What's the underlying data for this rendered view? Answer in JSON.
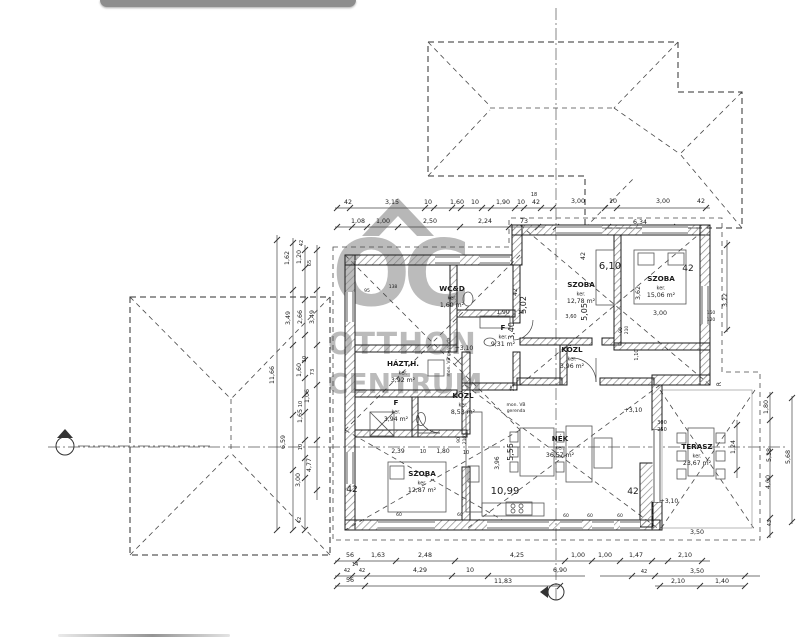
{
  "chrome": {
    "top_bar_color": "#8d8d8d"
  },
  "watermark": {
    "logo_text": "OC",
    "line1": "OTTHON",
    "line2": "CENTRUM",
    "color": "#7c7c7c"
  },
  "plan": {
    "rooms": [
      {
        "name": "WC&D",
        "mid": "ker.",
        "area": "1,60 m²",
        "x": 452,
        "y": 291
      },
      {
        "name": "F",
        "mid": "ker.",
        "area": "9,31 m²",
        "x": 503,
        "y": 330
      },
      {
        "name": "HÁZT.H.",
        "mid": "ker.",
        "area": "3,92 m²",
        "x": 403,
        "y": 366
      },
      {
        "name": "KÖZL",
        "mid": "ker.",
        "area": "8,53 m²",
        "x": 463,
        "y": 398
      },
      {
        "name": "F",
        "mid": "ker.",
        "area": "3,94 m²",
        "x": 396,
        "y": 405
      },
      {
        "name": "KÖZL",
        "mid": "ker.",
        "area": "3,96 m²",
        "x": 572,
        "y": 352
      },
      {
        "name": "SZOBA",
        "mid": "ker.",
        "area": "12,78 m²",
        "x": 581,
        "y": 287
      },
      {
        "name": "SZOBA",
        "mid": "ker.",
        "area": "15,06 m²",
        "x": 661,
        "y": 281
      },
      {
        "name": "SZOBA",
        "mid": "ker.",
        "area": "12,87 m²",
        "x": 422,
        "y": 476
      },
      {
        "name": "NÉK",
        "mid": "ker.",
        "area": "36,57 m²",
        "x": 560,
        "y": 441
      },
      {
        "name": "TERASZ",
        "mid": "ker.",
        "area": "23,67 m²",
        "x": 697,
        "y": 449
      }
    ],
    "dims": [
      {
        "t": "42",
        "x": 348,
        "y": 204
      },
      {
        "t": "3,15",
        "x": 392,
        "y": 204
      },
      {
        "t": "10",
        "x": 428,
        "y": 204
      },
      {
        "t": "1,60",
        "x": 457,
        "y": 204
      },
      {
        "t": "10",
        "x": 475,
        "y": 204
      },
      {
        "t": "1,90",
        "x": 503,
        "y": 204
      },
      {
        "t": "10",
        "x": 521,
        "y": 204
      },
      {
        "t": "42",
        "x": 536,
        "y": 204
      },
      {
        "t": "18",
        "x": 534,
        "y": 196,
        "s": 5
      },
      {
        "t": "3,00",
        "x": 578,
        "y": 203
      },
      {
        "t": "10",
        "x": 613,
        "y": 203
      },
      {
        "t": "3,00",
        "x": 663,
        "y": 203
      },
      {
        "t": "42",
        "x": 701,
        "y": 203
      },
      {
        "t": "1,08",
        "x": 358,
        "y": 223
      },
      {
        "t": "1,00",
        "x": 383,
        "y": 223
      },
      {
        "t": "2,50",
        "x": 430,
        "y": 223
      },
      {
        "t": "2,24",
        "x": 485,
        "y": 223
      },
      {
        "t": "73",
        "x": 524,
        "y": 223
      },
      {
        "t": "6,34",
        "x": 640,
        "y": 224
      },
      {
        "t": "56",
        "x": 350,
        "y": 557
      },
      {
        "t": "1,63",
        "x": 378,
        "y": 557
      },
      {
        "t": "2,48",
        "x": 425,
        "y": 557
      },
      {
        "t": "4,25",
        "x": 517,
        "y": 557
      },
      {
        "t": "1,00",
        "x": 578,
        "y": 557
      },
      {
        "t": "1,00",
        "x": 605,
        "y": 557
      },
      {
        "t": "1,47",
        "x": 636,
        "y": 557
      },
      {
        "t": "2,10",
        "x": 685,
        "y": 557
      },
      {
        "t": "14",
        "x": 355,
        "y": 566,
        "s": 5
      },
      {
        "t": "42",
        "x": 347,
        "y": 572,
        "s": 5
      },
      {
        "t": "42",
        "x": 362,
        "y": 572,
        "s": 5
      },
      {
        "t": "4,29",
        "x": 420,
        "y": 572
      },
      {
        "t": "10",
        "x": 470,
        "y": 572
      },
      {
        "t": "6,90",
        "x": 560,
        "y": 572
      },
      {
        "t": "42",
        "x": 644,
        "y": 573,
        "s": 5
      },
      {
        "t": "3,50",
        "x": 697,
        "y": 573
      },
      {
        "t": "56",
        "x": 350,
        "y": 582
      },
      {
        "t": "11,83",
        "x": 503,
        "y": 583
      },
      {
        "t": "2,10",
        "x": 678,
        "y": 583
      },
      {
        "t": "1,40",
        "x": 722,
        "y": 583
      },
      {
        "t": "1,62",
        "x": 289,
        "y": 258,
        "r": 1
      },
      {
        "t": "1,20",
        "x": 301,
        "y": 257,
        "r": 1
      },
      {
        "t": "42",
        "x": 303,
        "y": 243,
        "r": 1,
        "s": 5
      },
      {
        "t": "65",
        "x": 311,
        "y": 263,
        "r": 1,
        "s": 5
      },
      {
        "t": "3,49",
        "x": 290,
        "y": 318,
        "r": 1
      },
      {
        "t": "2,66",
        "x": 302,
        "y": 317,
        "r": 1
      },
      {
        "t": "3,49",
        "x": 314,
        "y": 317,
        "r": 1
      },
      {
        "t": "11,66",
        "x": 274,
        "y": 375,
        "r": 1
      },
      {
        "t": "10",
        "x": 306,
        "y": 359,
        "r": 1,
        "s": 5
      },
      {
        "t": "1,60",
        "x": 301,
        "y": 370,
        "r": 1
      },
      {
        "t": "73",
        "x": 314,
        "y": 372,
        "r": 1,
        "s": 5
      },
      {
        "t": "1,06",
        "x": 309,
        "y": 396,
        "r": 1
      },
      {
        "t": "10",
        "x": 302,
        "y": 404,
        "r": 1,
        "s": 5
      },
      {
        "t": "1,65",
        "x": 302,
        "y": 416,
        "r": 1
      },
      {
        "t": "6,59",
        "x": 285,
        "y": 442,
        "r": 1
      },
      {
        "t": "10",
        "x": 302,
        "y": 447,
        "r": 1,
        "s": 5
      },
      {
        "t": "4,77",
        "x": 311,
        "y": 465,
        "r": 1
      },
      {
        "t": "3,00",
        "x": 300,
        "y": 480,
        "r": 1
      },
      {
        "t": "42",
        "x": 301,
        "y": 520,
        "r": 1,
        "s": 5
      },
      {
        "t": "3,22",
        "x": 727,
        "y": 300,
        "r": 1
      },
      {
        "t": "1,80",
        "x": 768,
        "y": 407,
        "r": 1
      },
      {
        "t": "1,24",
        "x": 735,
        "y": 447,
        "r": 1
      },
      {
        "t": "5,38",
        "x": 771,
        "y": 455,
        "r": 1
      },
      {
        "t": "5,68",
        "x": 790,
        "y": 457,
        "r": 1
      },
      {
        "t": "4,00",
        "x": 770,
        "y": 482,
        "r": 1
      },
      {
        "t": "43",
        "x": 771,
        "y": 523,
        "r": 1,
        "s": 5
      },
      {
        "t": "3,50",
        "x": 697,
        "y": 534
      },
      {
        "t": "6,10",
        "x": 610,
        "y": 269,
        "s": 10
      },
      {
        "t": "42",
        "x": 585,
        "y": 256,
        "r": 1
      },
      {
        "t": "42",
        "x": 688,
        "y": 271,
        "s": 9
      },
      {
        "t": "3,62",
        "x": 640,
        "y": 293,
        "r": 1
      },
      {
        "t": "3,00",
        "x": 660,
        "y": 315
      },
      {
        "t": "150",
        "x": 711,
        "y": 314,
        "s": 4.5
      },
      {
        "t": "120",
        "x": 711,
        "y": 321,
        "s": 4.5
      },
      {
        "t": "5,02",
        "x": 526,
        "y": 305,
        "r": 1,
        "s": 8
      },
      {
        "t": "5,05",
        "x": 587,
        "y": 312,
        "r": 1,
        "s": 8
      },
      {
        "t": "3,60",
        "x": 571,
        "y": 318,
        "s": 5
      },
      {
        "t": "1,90",
        "x": 503,
        "y": 314,
        "s": 6
      },
      {
        "t": "10",
        "x": 521,
        "y": 314,
        "s": 5
      },
      {
        "t": "3,40",
        "x": 514,
        "y": 331,
        "r": 1,
        "s": 8
      },
      {
        "t": "42",
        "x": 517,
        "y": 292,
        "r": 1,
        "s": 6
      },
      {
        "t": "+3,10",
        "x": 464,
        "y": 350,
        "s": 6
      },
      {
        "t": "+3,10",
        "x": 633,
        "y": 412,
        "s": 6
      },
      {
        "t": "+3,10",
        "x": 669,
        "y": 503,
        "s": 6
      },
      {
        "t": "mon. VB",
        "x": 516,
        "y": 406,
        "s": 4.5
      },
      {
        "t": "gerenda",
        "x": 516,
        "y": 412,
        "s": 4.5
      },
      {
        "t": "mon. VB gerenda",
        "x": 450,
        "y": 357,
        "r": 1,
        "s": 4.5
      },
      {
        "t": "2,39",
        "x": 398,
        "y": 453,
        "s": 6
      },
      {
        "t": "10",
        "x": 423,
        "y": 453,
        "s": 5
      },
      {
        "t": "1,80",
        "x": 443,
        "y": 453,
        "s": 6
      },
      {
        "t": "10",
        "x": 466,
        "y": 454,
        "s": 5
      },
      {
        "t": "5,55",
        "x": 513,
        "y": 452,
        "r": 1,
        "s": 8
      },
      {
        "t": "3,96",
        "x": 499,
        "y": 463,
        "r": 1,
        "s": 6
      },
      {
        "t": "10,99",
        "x": 505,
        "y": 494,
        "s": 10
      },
      {
        "t": "42",
        "x": 352,
        "y": 492,
        "s": 9
      },
      {
        "t": "42",
        "x": 633,
        "y": 494,
        "s": 9
      },
      {
        "t": "25",
        "x": 514,
        "y": 388,
        "r": 1,
        "s": 5
      },
      {
        "t": "90",
        "x": 460,
        "y": 440,
        "r": 1,
        "s": 4.5
      },
      {
        "t": "210",
        "x": 466,
        "y": 440,
        "r": 1,
        "s": 4.5
      },
      {
        "t": "90",
        "x": 622,
        "y": 330,
        "r": 1,
        "s": 4.5
      },
      {
        "t": "210",
        "x": 628,
        "y": 330,
        "r": 1,
        "s": 4.5
      },
      {
        "t": "1,10",
        "x": 638,
        "y": 355,
        "r": 1,
        "s": 5
      },
      {
        "t": "300",
        "x": 662,
        "y": 424,
        "s": 5
      },
      {
        "t": "250",
        "x": 662,
        "y": 431,
        "s": 5
      },
      {
        "t": "60",
        "x": 399,
        "y": 516,
        "s": 4.5
      },
      {
        "t": "60",
        "x": 460,
        "y": 516,
        "s": 4.5
      },
      {
        "t": "60",
        "x": 566,
        "y": 517,
        "s": 4.5
      },
      {
        "t": "60",
        "x": 590,
        "y": 517,
        "s": 4.5
      },
      {
        "t": "60",
        "x": 620,
        "y": 517,
        "s": 4.5
      },
      {
        "t": "95",
        "x": 367,
        "y": 292,
        "s": 4.5
      },
      {
        "t": "138",
        "x": 393,
        "y": 288,
        "s": 4.5
      },
      {
        "t": "R",
        "x": 721,
        "y": 384,
        "r": 1,
        "s": 6
      }
    ]
  }
}
